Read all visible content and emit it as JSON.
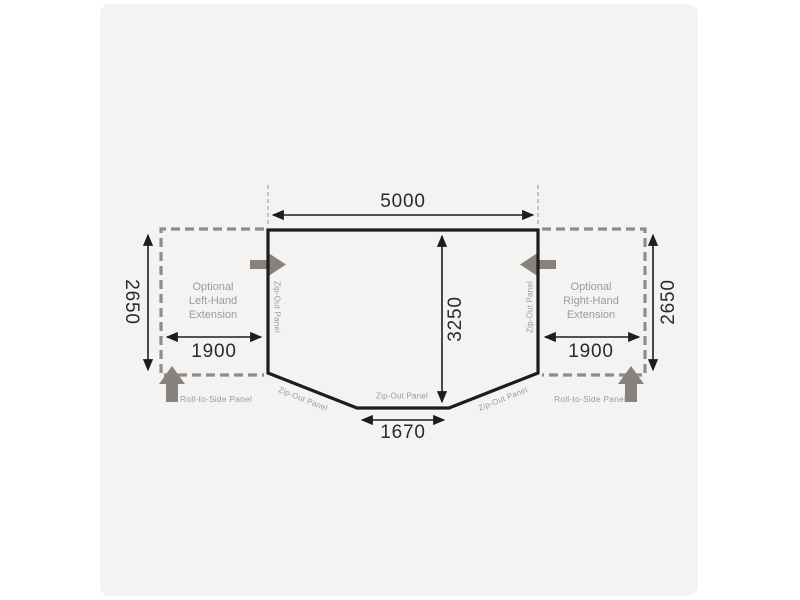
{
  "page": {
    "background": "#ffffff",
    "panel_background": "#f4f3f2"
  },
  "colors": {
    "outline_black": "#1d1d1b",
    "dimension_line_black": "#1d1d1b",
    "dimension_text": "#2a2a28",
    "dashed_extension_gray": "#8d8d8d",
    "solid_arrow_gray": "#87827e",
    "label_gray": "#9b9b9b",
    "guide_line_gray": "#a5a5a5"
  },
  "diagram": {
    "dimensions": {
      "top_width": "5000",
      "depth": "3250",
      "front_panel_width": "1670",
      "left_extension_width": "1900",
      "right_extension_width": "1900",
      "left_extension_depth": "2650",
      "right_extension_depth": "2650"
    },
    "extensions": {
      "left": {
        "line1": "Optional",
        "line2": "Left-Hand",
        "line3": "Extension"
      },
      "right": {
        "line1": "Optional",
        "line2": "Right-Hand",
        "line3": "Extension"
      }
    },
    "panels": {
      "left_side": "Zip-Out Panel",
      "right_side": "Zip-Out Panel",
      "front_left": "Zip-Out Panel",
      "front_center": "Zip-Out Panel",
      "front_right": "Zip-Out Panel",
      "roll_to_side_left": "Roll-to-Side Panel",
      "roll_to_side_right": "Roll-to-Side Panel"
    }
  }
}
